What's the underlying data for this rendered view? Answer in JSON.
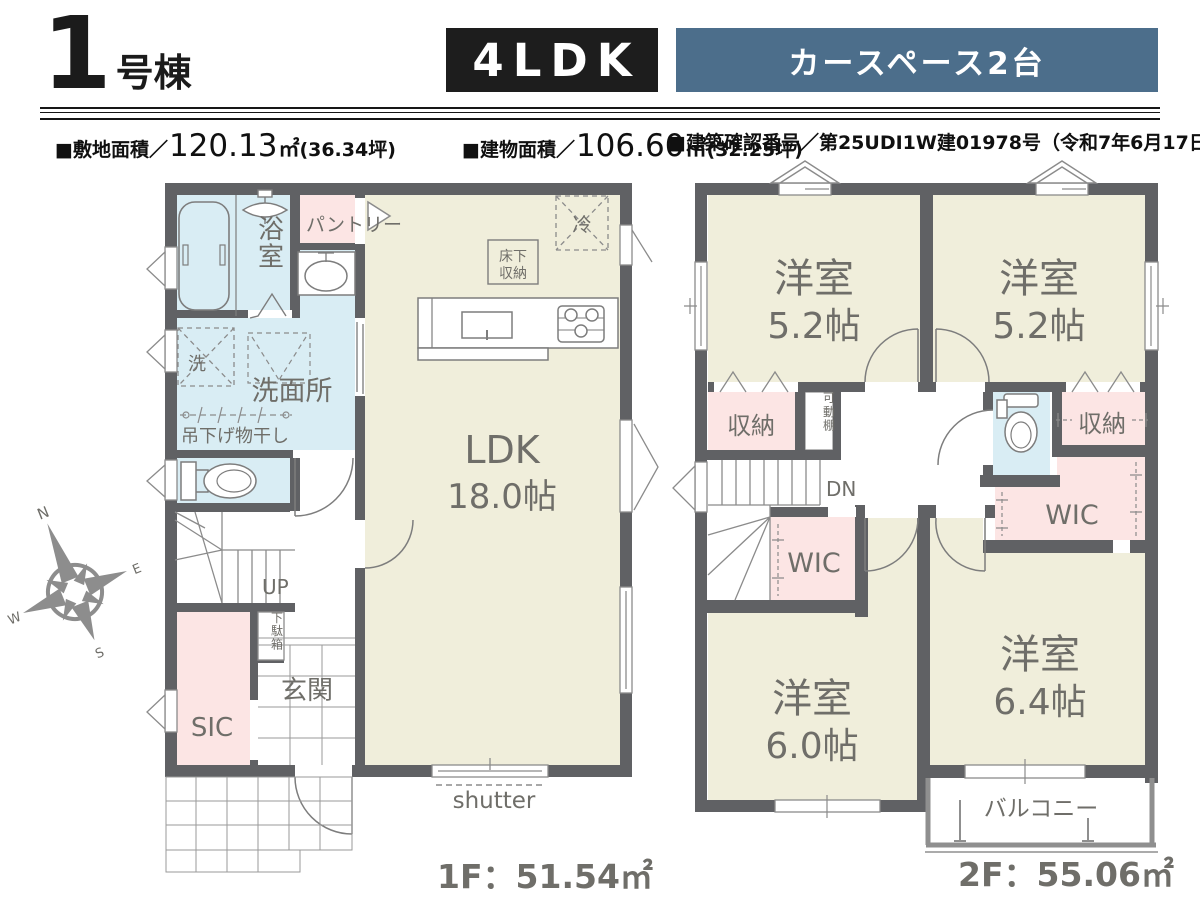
{
  "header": {
    "building_number": "1",
    "building_suffix": "号棟",
    "layout_badge": "4LDK",
    "feature_badge": "カースペース2台"
  },
  "info": {
    "site": {
      "label": "■敷地面積／",
      "value": "120.13",
      "unit": "㎡",
      "tsubo": "(36.34坪)"
    },
    "building": {
      "label": "■建物面積／",
      "value": "106.60",
      "unit": "㎡",
      "tsubo": "(32.25坪)"
    },
    "permit": "■建築確認番号／第25UDI1W建01978号（令和7年6月17日）"
  },
  "floor1": {
    "area_label": "1F：51.54㎡",
    "bath": "浴室",
    "pantry": "パントリー",
    "laundry": "洗",
    "washroom": "洗面所",
    "hanging_rod": "吊下げ物干し",
    "ldk_name": "LDK",
    "ldk_size": "18.0帖",
    "fridge": "冷",
    "floor_storage_line1": "床下",
    "floor_storage_line2": "収納",
    "stairs_up": "UP",
    "shoe_box": "下駄箱",
    "entrance": "玄関",
    "sic": "SIC",
    "shutter": "shutter"
  },
  "floor2": {
    "area_label": "2F：55.06㎡",
    "bedroom1_name": "洋室",
    "bedroom1_size": "5.2帖",
    "bedroom2_name": "洋室",
    "bedroom2_size": "5.2帖",
    "storage_left": "収納",
    "movable_shelf": "可動棚",
    "storage_right": "収納",
    "stairs_down": "DN",
    "wic_middle": "WIC",
    "wic_right": "WIC",
    "bedroom3_name": "洋室",
    "bedroom3_size": "6.0帖",
    "bedroom4_name": "洋室",
    "bedroom4_size": "6.4帖",
    "balcony": "バルコニー"
  },
  "compass": {
    "n": "N",
    "e": "E",
    "s": "S",
    "w": "W"
  },
  "colors": {
    "badge_blue": "#4c6e8b",
    "badge_black": "#1d1d1d",
    "wall": "#606164",
    "room_cream": "#f0eedb",
    "room_blue": "#d9edf4",
    "room_pink": "#fce5e4",
    "label_gray": "#6f6e69"
  }
}
